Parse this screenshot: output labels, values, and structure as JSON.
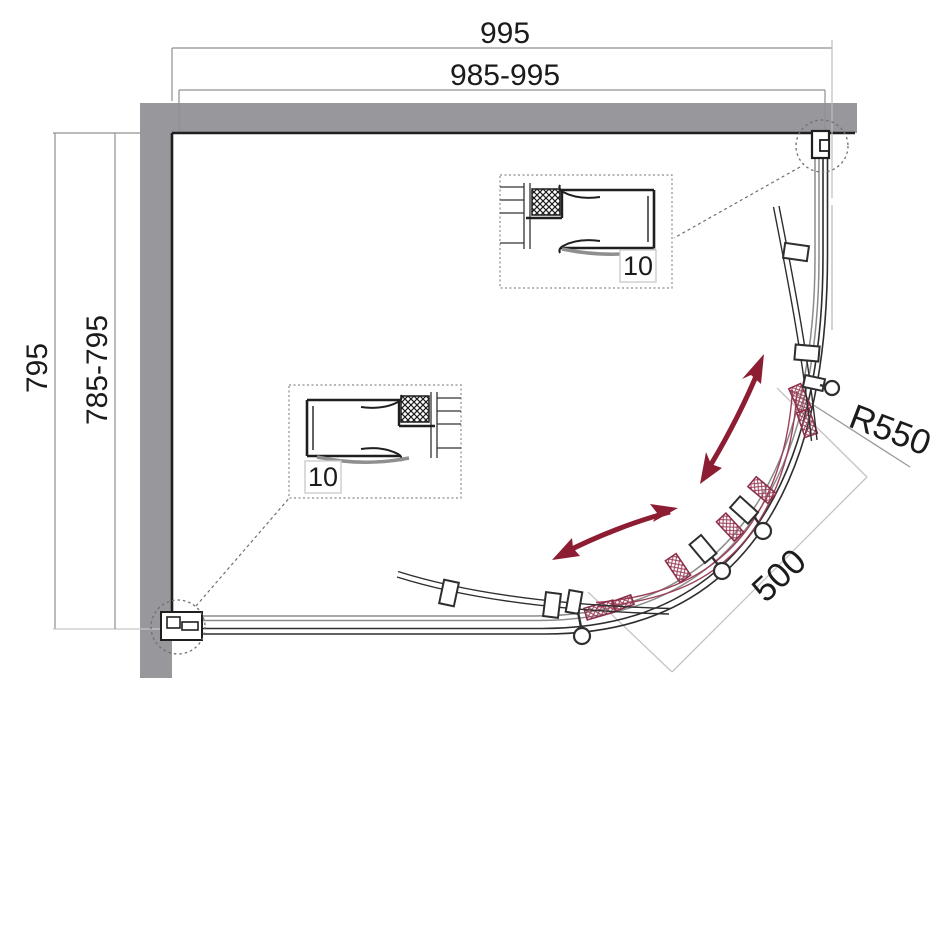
{
  "title": "Quadrant shower enclosure plan drawing",
  "dimensions": {
    "width_overall": "995",
    "width_adjust": "985-995",
    "depth_overall": "795",
    "depth_adjust": "785-795",
    "radius": "R550",
    "entry_width": "500"
  },
  "details": {
    "top_profile_label": "10",
    "bottom_profile_label": "10"
  },
  "colors": {
    "wall_gray": "#98979b",
    "line_black": "#1f1f1f",
    "track_gray": "#8b8b8b",
    "dim_gray": "#909090",
    "dim_light": "#c6c6c6",
    "arrow_red": "#8c1d33",
    "door_red": "#9b4058"
  }
}
